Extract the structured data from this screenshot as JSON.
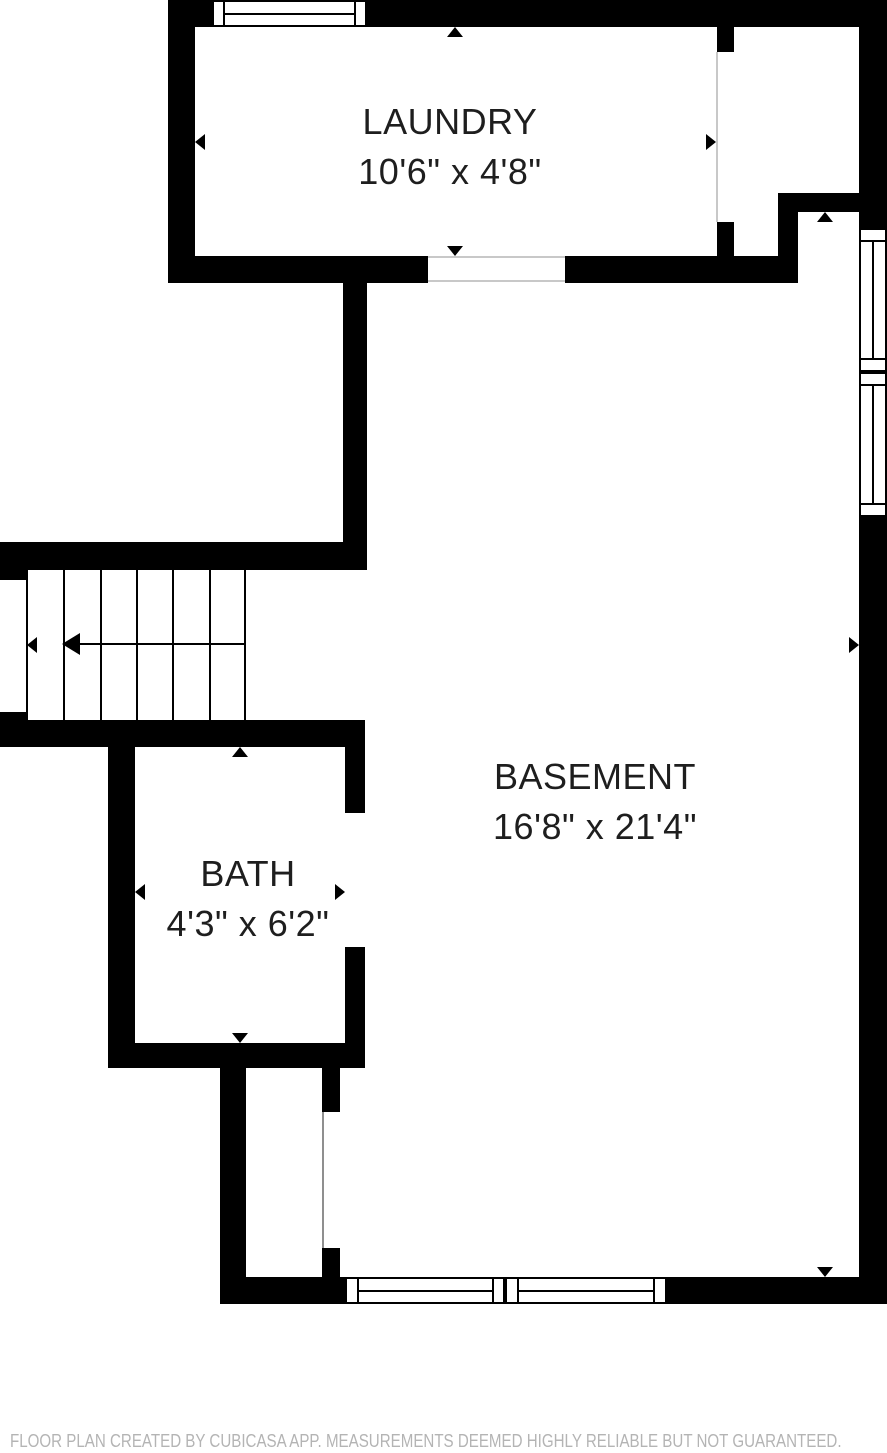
{
  "rooms": [
    {
      "name": "LAUNDRY",
      "dims": "10'6\" x 4'8\""
    },
    {
      "name": "BASEMENT",
      "dims": "16'8\" x 21'4\""
    },
    {
      "name": "BATH",
      "dims": "4'3\" x 6'2\""
    }
  ],
  "footer": {
    "disclaimer": "FLOOR PLAN CREATED BY CUBICASA APP. MEASUREMENTS DEEMED HIGHLY RELIABLE BUT NOT GUARANTEED."
  },
  "colors": {
    "wall": "#000000",
    "background": "#ffffff",
    "room_text": "#1e1e1e",
    "disclaimer_text": "#b4b4b4",
    "door_line": "#c8c8c8"
  }
}
